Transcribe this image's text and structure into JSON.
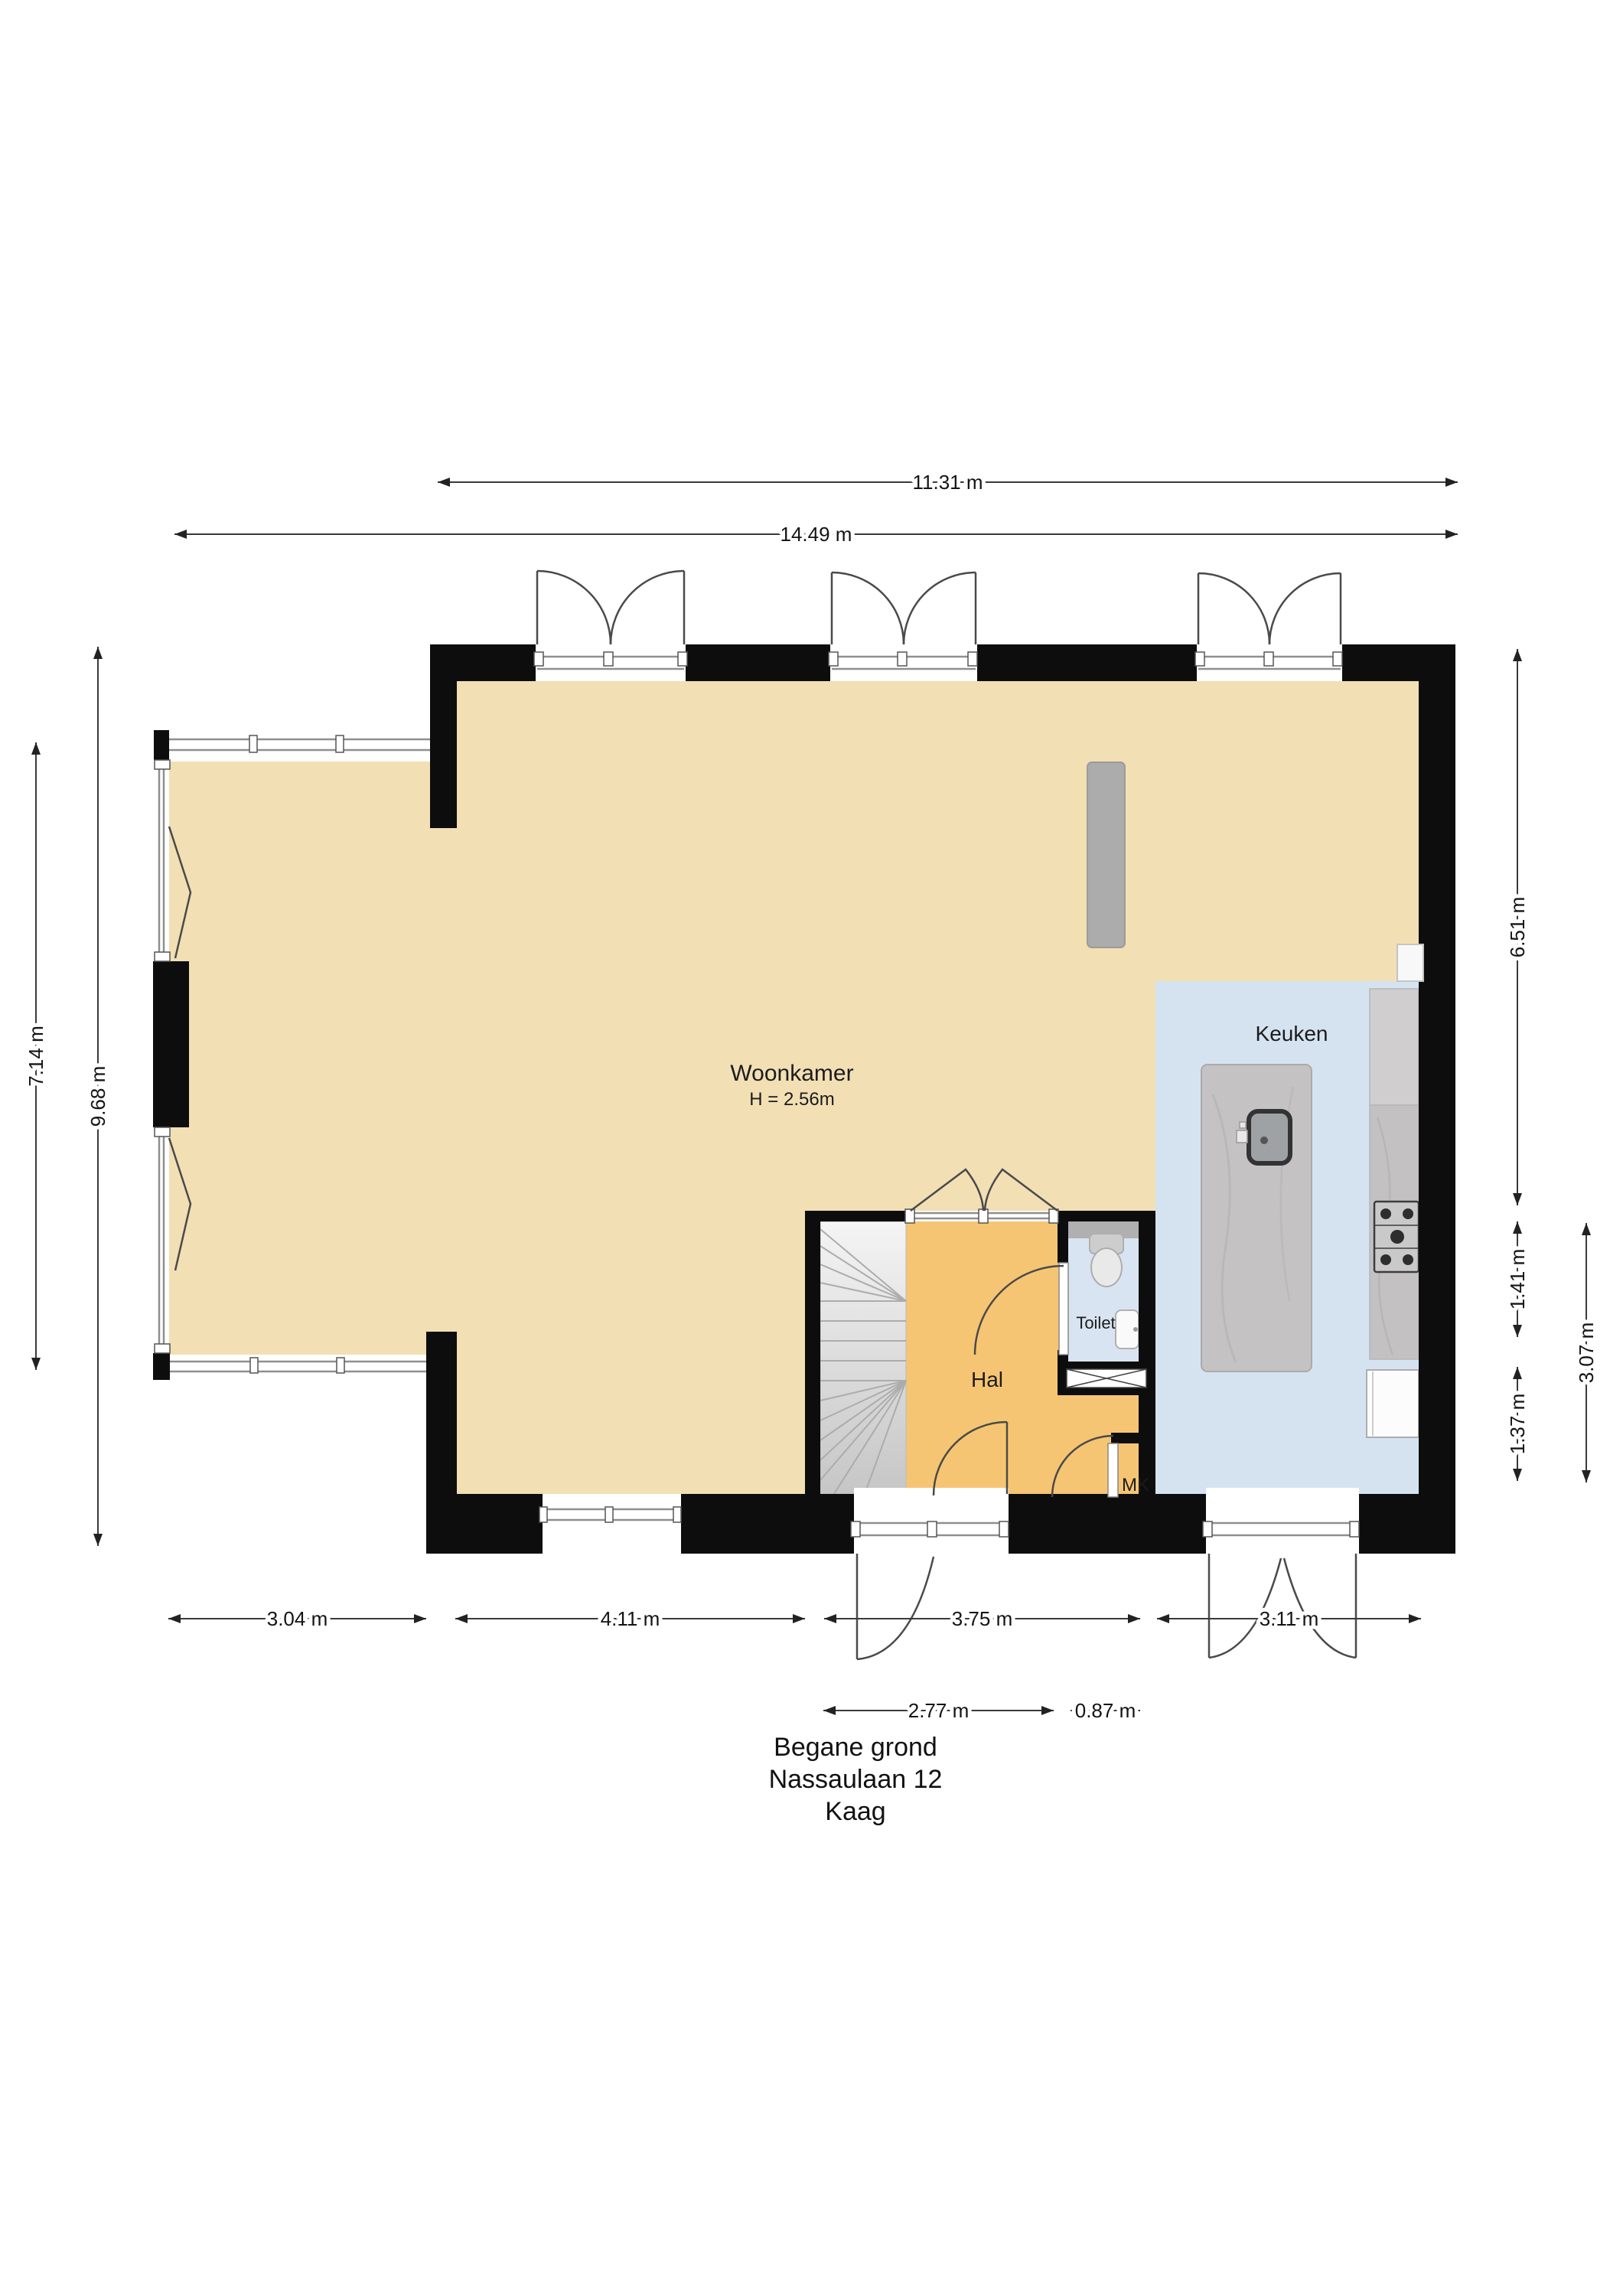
{
  "title": {
    "line1": "Begane grond",
    "line2": "Nassaulaan 12",
    "line3": "Kaag"
  },
  "rooms": {
    "woonkamer": {
      "label": "Woonkamer",
      "ceiling_height": "H = 2.56m"
    },
    "keuken": {
      "label": "Keuken"
    },
    "hal": {
      "label": "Hal"
    },
    "toilet": {
      "label": "Toilet"
    },
    "mk": {
      "label": "MK"
    }
  },
  "dimensions": {
    "top_inner": "11.31 m",
    "top_outer": "14.49 m",
    "left_inner": "7.14 m",
    "left_outer": "9.68 m",
    "right_upper": "6.51 m",
    "right_mid": "1.41 m",
    "right_lower": "1.37 m",
    "right_outer": "3.07 m",
    "bottom_1": "3.04 m",
    "bottom_2": "4.11 m",
    "bottom_3": "3.75 m",
    "bottom_4": "3.11 m",
    "sub_1": "2.77 m",
    "sub_2": "0.87 m"
  },
  "colors": {
    "living": "#F2DFB4",
    "hall": "#F6C573",
    "kitchen": "#D5E3F1",
    "toilet": "#D8E4F1",
    "wall": "#0D0D0D"
  }
}
